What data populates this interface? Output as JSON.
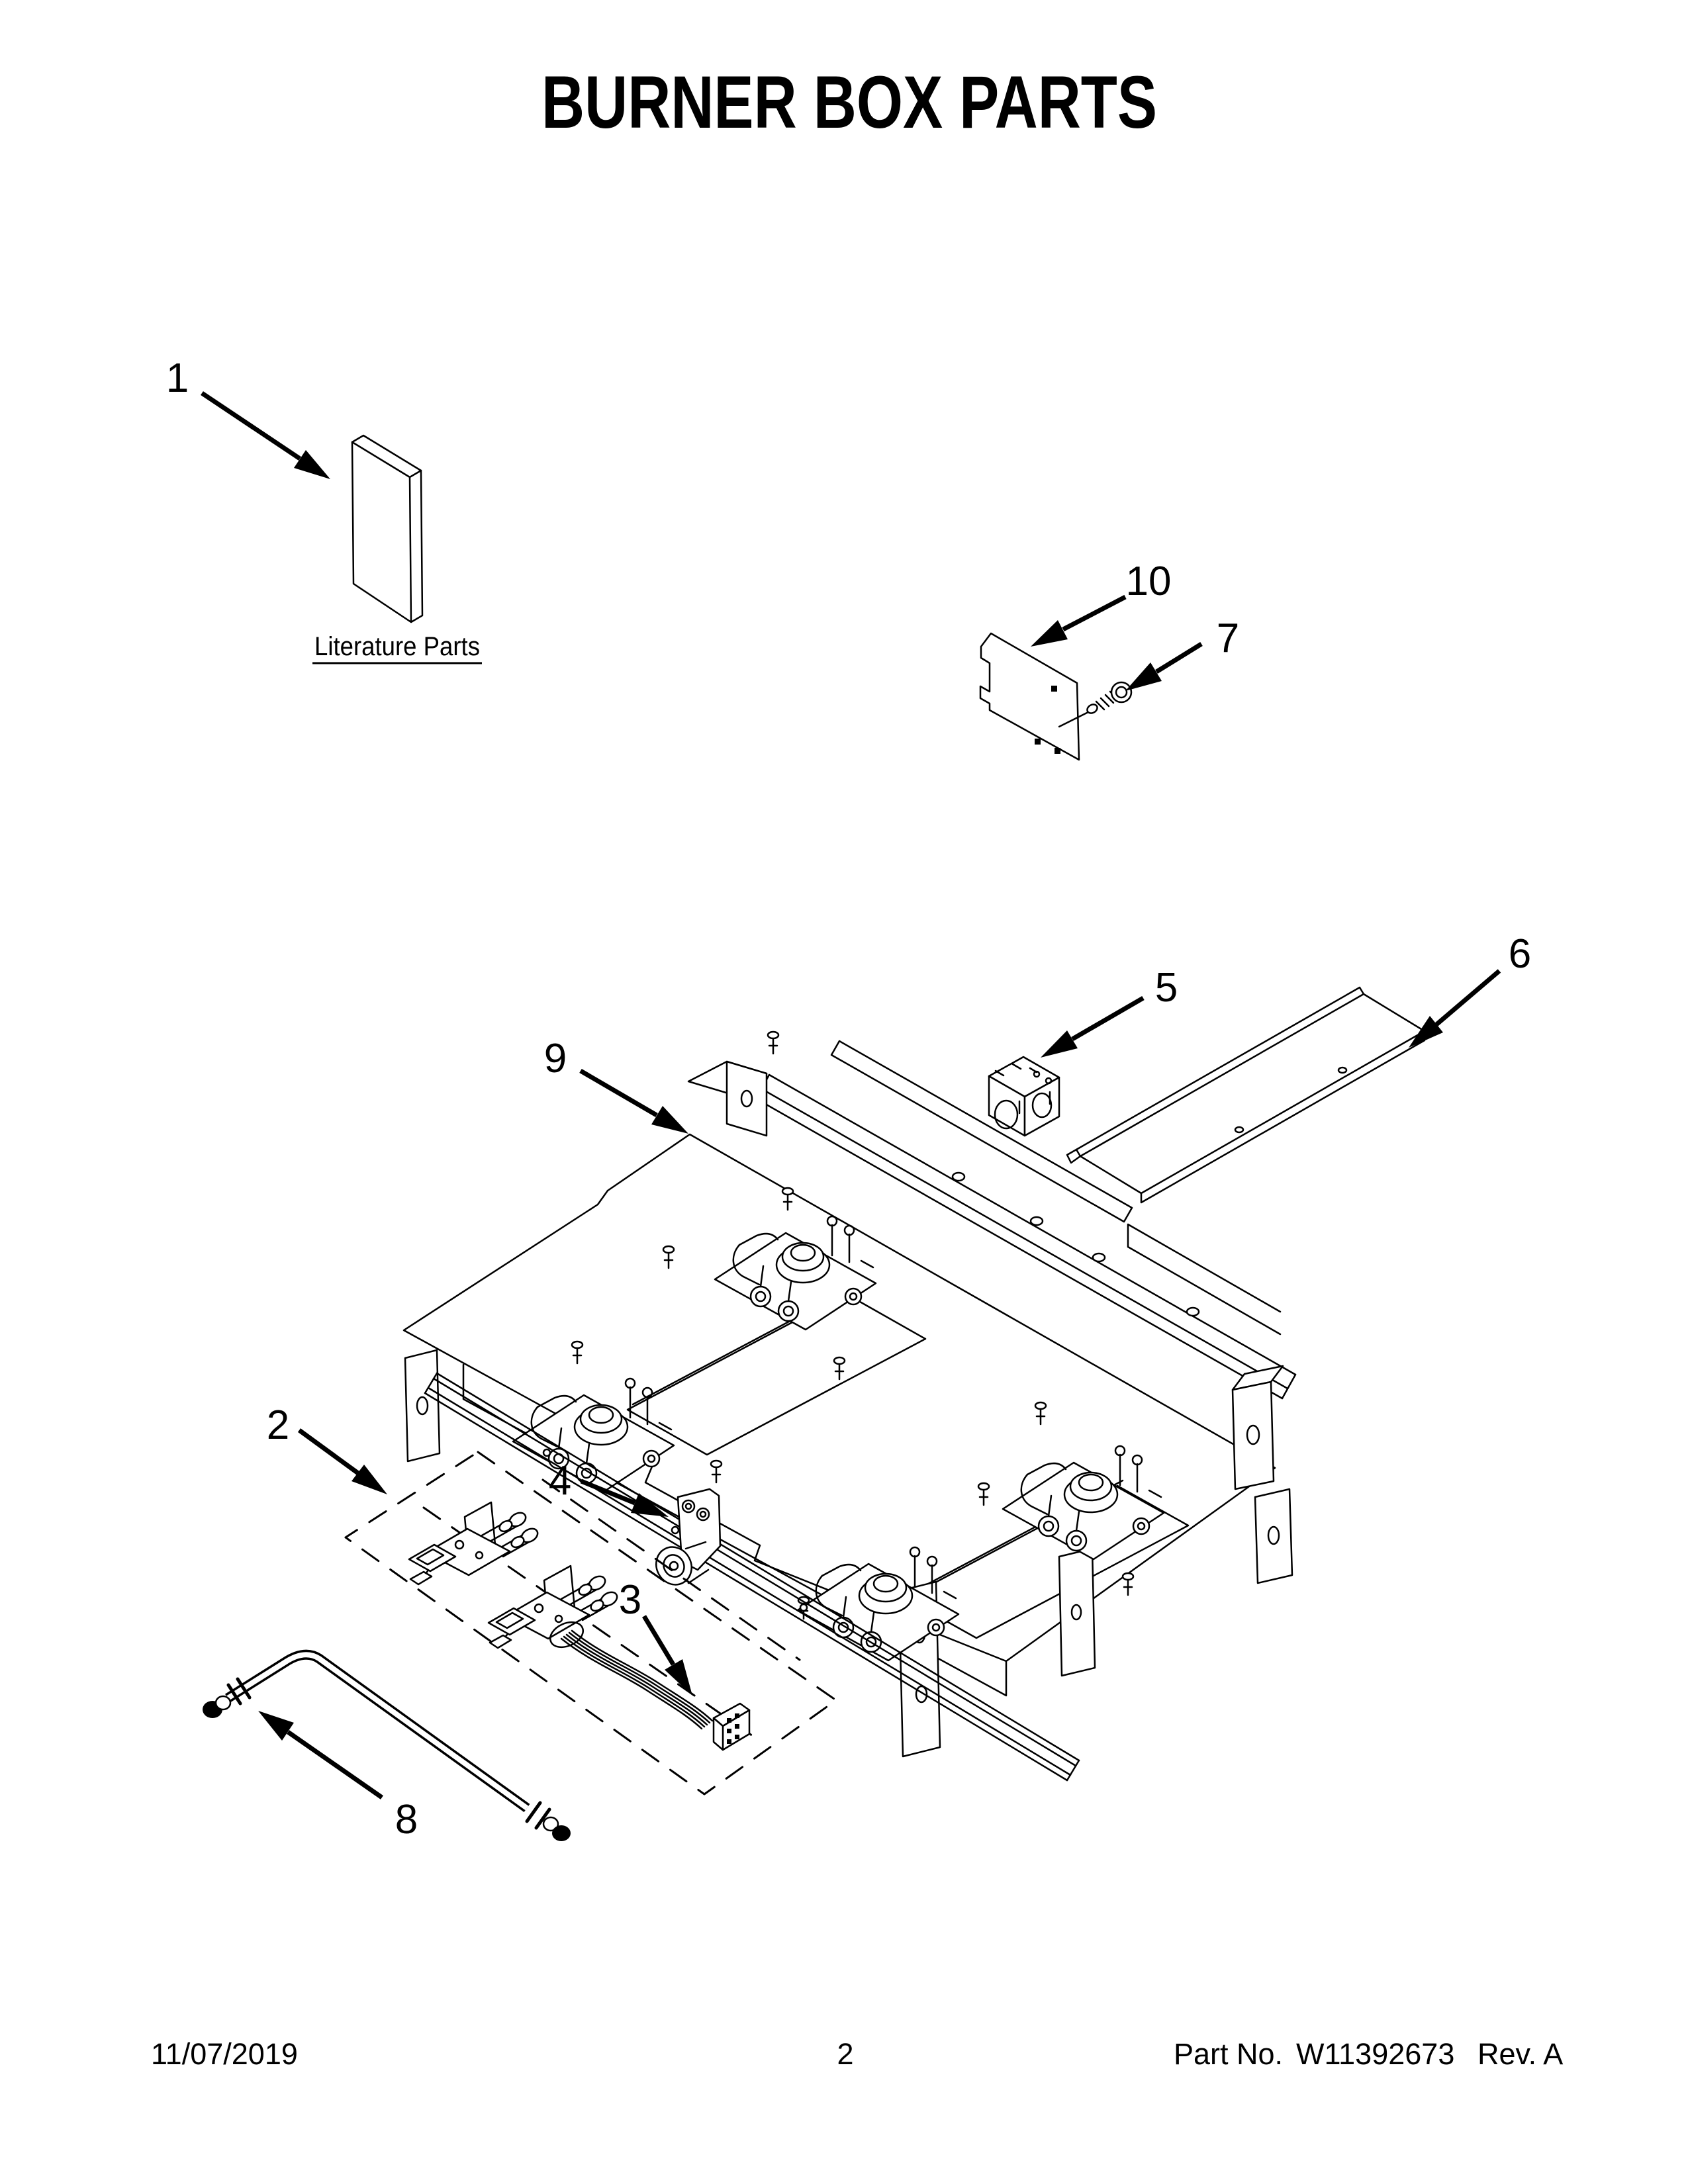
{
  "title": "BURNER BOX PARTS",
  "colors": {
    "ink": "#000000",
    "paper": "#ffffff"
  },
  "diagram": {
    "literature_caption": "Literature Parts",
    "callouts": [
      {
        "number": "1"
      },
      {
        "number": "2"
      },
      {
        "number": "3"
      },
      {
        "number": "4"
      },
      {
        "number": "5"
      },
      {
        "number": "6"
      },
      {
        "number": "7"
      },
      {
        "number": "8"
      },
      {
        "number": "9"
      },
      {
        "number": "10"
      }
    ]
  },
  "footer": {
    "date": "11/07/2019",
    "page_number": "2",
    "part_no_label": "Part No.",
    "part_no": "W11392673",
    "revision": "Rev. A"
  }
}
